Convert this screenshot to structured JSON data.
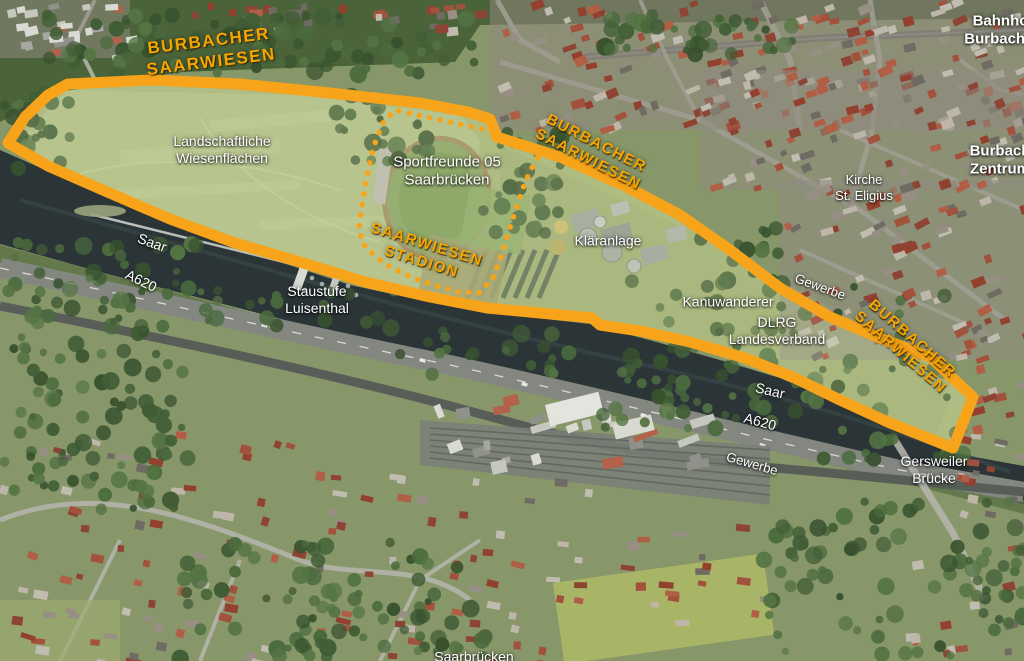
{
  "map": {
    "title": "Burbacher Saarwiesen aerial overview",
    "colors": {
      "boundary_orange": "#F7A41B",
      "label_orange": "#F7A600",
      "river_dark": "#2B3538",
      "meadow_green": "#AABA7E",
      "forest_green": "#47633B"
    },
    "overlay": {
      "boundary_points": "8,143 25,117 48,95 68,84 150,80 240,84 330,93 420,103 468,112 490,119 497,137 560,157 625,186 680,215 730,250 780,288 830,317 880,338 930,357 973,397 953,448 890,423 840,400 795,378 745,358 690,342 640,331 600,325 592,318 540,313 487,308 430,297 365,282 300,262 235,243 170,219 105,191 48,166",
      "stadium_dotted_points": "492,131 463,125 440,120 417,115 395,110 383,123 373,148 367,176 362,205 359,228 363,244 376,257 392,268 413,278 437,286 459,292 479,293 493,278 501,256 509,231 516,209 523,188 530,171 538,157 544,150"
    },
    "labels": [
      {
        "id": "burbacher-saarwiesen-nw",
        "lines": [
          "BURBACHER",
          "SAARWIESEN"
        ],
        "x": 210,
        "y": 52,
        "rot": -7,
        "cls": "orange",
        "size": 17
      },
      {
        "id": "burbacher-saarwiesen-mid",
        "lines": [
          "BURBACHER",
          "SAARWIESEN"
        ],
        "x": 592,
        "y": 152,
        "rot": 27,
        "cls": "orange",
        "size": 15
      },
      {
        "id": "burbacher-saarwiesen-east",
        "lines": [
          "BURBACHER",
          "SAARWIESEN"
        ],
        "x": 906,
        "y": 346,
        "rot": 41,
        "cls": "orange",
        "size": 15
      },
      {
        "id": "saarwiesen-stadion",
        "lines": [
          "SAARWIESEN",
          "STADION"
        ],
        "x": 424,
        "y": 254,
        "rot": 17,
        "cls": "orange",
        "size": 15
      },
      {
        "id": "landschaftliche-wiesenflaechen",
        "lines": [
          "Landschaftliche",
          "Wiesenflächen"
        ],
        "x": 222,
        "y": 150,
        "rot": 0,
        "cls": "white",
        "size": 14
      },
      {
        "id": "sportfreunde-05-saarbruecken",
        "lines": [
          "Sportfreunde 05",
          "Saarbrücken"
        ],
        "x": 447,
        "y": 172,
        "rot": 0,
        "cls": "white",
        "size": 15
      },
      {
        "id": "klaeranlage",
        "lines": [
          "Kläranlage"
        ],
        "x": 608,
        "y": 241,
        "rot": 0,
        "cls": "white",
        "size": 14
      },
      {
        "id": "kanuwanderer",
        "lines": [
          "Kanuwanderer"
        ],
        "x": 728,
        "y": 302,
        "rot": 0,
        "cls": "white",
        "size": 14
      },
      {
        "id": "dlrg-landesverband",
        "lines": [
          "DLRG",
          "Landesverband"
        ],
        "x": 777,
        "y": 331,
        "rot": 0,
        "cls": "white",
        "size": 14
      },
      {
        "id": "staustufe-luisenthal",
        "lines": [
          "Staustufe",
          "Luisenthal"
        ],
        "x": 317,
        "y": 300,
        "rot": 0,
        "cls": "white",
        "size": 14
      },
      {
        "id": "saar-west",
        "lines": [
          "Saar"
        ],
        "x": 152,
        "y": 243,
        "rot": 20,
        "cls": "white",
        "size": 14
      },
      {
        "id": "a620-west",
        "lines": [
          "A620"
        ],
        "x": 141,
        "y": 281,
        "rot": 26,
        "cls": "white",
        "size": 14
      },
      {
        "id": "saar-east",
        "lines": [
          "Saar"
        ],
        "x": 770,
        "y": 391,
        "rot": 13,
        "cls": "white",
        "size": 14
      },
      {
        "id": "a620-east",
        "lines": [
          "A620"
        ],
        "x": 760,
        "y": 422,
        "rot": 15,
        "cls": "white",
        "size": 14
      },
      {
        "id": "gewerbe-east",
        "lines": [
          "Gewerbe"
        ],
        "x": 820,
        "y": 287,
        "rot": 20,
        "cls": "white",
        "size": 13
      },
      {
        "id": "gewerbe-south",
        "lines": [
          "Gewerbe"
        ],
        "x": 752,
        "y": 464,
        "rot": 16,
        "cls": "white",
        "size": 13
      },
      {
        "id": "gersweiler-bruecke",
        "lines": [
          "Gersweiler",
          "Brücke"
        ],
        "x": 934,
        "y": 470,
        "rot": 0,
        "cls": "white",
        "size": 14
      },
      {
        "id": "kirche-st-eligius",
        "lines": [
          "Kirche",
          "St. Eligius"
        ],
        "x": 864,
        "y": 188,
        "rot": 0,
        "cls": "white",
        "size": 13
      },
      {
        "id": "burbach-zentrum",
        "lines": [
          "Burbach",
          "Zentrum"
        ],
        "x": 1000,
        "y": 161,
        "rot": 0,
        "cls": "white-bold",
        "size": 15
      },
      {
        "id": "bahnhof-burbach",
        "lines": [
          "Bahnhof",
          "Burbach M"
        ],
        "x": 1003,
        "y": 31,
        "rot": 0,
        "cls": "white-bold",
        "size": 15
      },
      {
        "id": "saarbruecken-south",
        "lines": [
          "Saarbrücken"
        ],
        "x": 474,
        "y": 657,
        "rot": 0,
        "cls": "white",
        "size": 14
      }
    ]
  }
}
